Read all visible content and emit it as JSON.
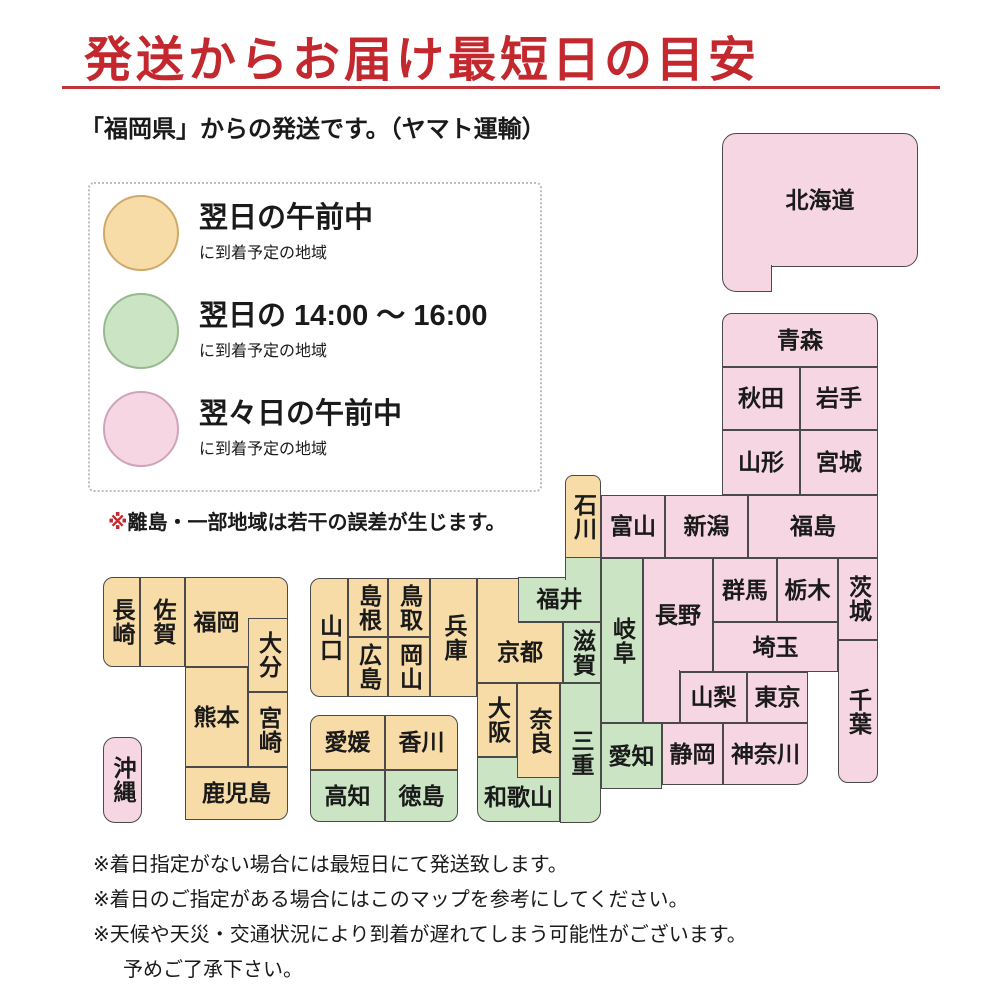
{
  "title": "発送からお届け最短日の目安",
  "subtitle": "「福岡県」からの発送です。（ヤマト運輸）",
  "colors": {
    "next_day_morning": "#f8dca8",
    "next_day_afternoon": "#cbe5c4",
    "two_days_later_morning": "#f5d6e2",
    "title_red": "#c3282e",
    "tile_border": "#4a4a4a"
  },
  "legend": {
    "items": [
      {
        "color": "orange",
        "label": "翌日の午前中",
        "sublabel": "に到着予定の地域"
      },
      {
        "color": "green",
        "label": "翌日の 14:00 ～ 16:00",
        "sublabel": "に到着予定の地域"
      },
      {
        "color": "pink",
        "label": "翌々日の午前中",
        "sublabel": "に到着予定の地域"
      }
    ],
    "note_mark": "※",
    "note": "離島・一部地域は若干の誤差が生じます。"
  },
  "map": {
    "prefectures": [
      {
        "key": "hokkaido",
        "name": "北海道",
        "color": "pink",
        "orient": "h",
        "parts": [
          {
            "x": 722,
            "y": 133,
            "w": 196,
            "h": 134,
            "r": "14px 14px 14px 0"
          },
          {
            "x": 722,
            "y": 265,
            "w": 50,
            "h": 27,
            "r": "0 0 0 14px",
            "b": "lrb"
          }
        ]
      },
      {
        "key": "aomori",
        "name": "青森",
        "color": "pink",
        "orient": "h",
        "parts": [
          {
            "x": 722,
            "y": 313,
            "w": 156,
            "h": 54,
            "r": "10px 10px 0 0"
          }
        ]
      },
      {
        "key": "akita",
        "name": "秋田",
        "color": "pink",
        "orient": "h",
        "parts": [
          {
            "x": 722,
            "y": 367,
            "w": 78,
            "h": 63
          }
        ]
      },
      {
        "key": "iwate",
        "name": "岩手",
        "color": "pink",
        "orient": "h",
        "parts": [
          {
            "x": 800,
            "y": 367,
            "w": 78,
            "h": 63
          }
        ]
      },
      {
        "key": "yamagata",
        "name": "山形",
        "color": "pink",
        "orient": "h",
        "parts": [
          {
            "x": 722,
            "y": 430,
            "w": 78,
            "h": 65
          }
        ]
      },
      {
        "key": "miyagi",
        "name": "宮城",
        "color": "pink",
        "orient": "h",
        "parts": [
          {
            "x": 800,
            "y": 430,
            "w": 78,
            "h": 65
          }
        ]
      },
      {
        "key": "niigata",
        "name": "新潟",
        "color": "pink",
        "orient": "h",
        "parts": [
          {
            "x": 665,
            "y": 495,
            "w": 83,
            "h": 63
          }
        ]
      },
      {
        "key": "fukushima",
        "name": "福島",
        "color": "pink",
        "orient": "h",
        "parts": [
          {
            "x": 748,
            "y": 495,
            "w": 130,
            "h": 63
          }
        ]
      },
      {
        "key": "toyama",
        "name": "富山",
        "color": "pink",
        "orient": "h",
        "parts": [
          {
            "x": 601,
            "y": 495,
            "w": 64,
            "h": 63
          }
        ]
      },
      {
        "key": "ishikawa",
        "name": "石川",
        "color": "orange",
        "orient": "v",
        "parts": [
          {
            "x": 565,
            "y": 475,
            "w": 36,
            "h": 83,
            "r": "8px 8px 0 0"
          }
        ]
      },
      {
        "key": "fukui",
        "name": "福井",
        "color": "green",
        "orient": "h",
        "parts": [
          {
            "x": 518,
            "y": 577,
            "w": 83,
            "h": 45
          },
          {
            "x": 565,
            "y": 558,
            "w": 36,
            "h": 22,
            "b": "lr"
          }
        ]
      },
      {
        "key": "gunma",
        "name": "群馬",
        "color": "pink",
        "orient": "h",
        "parts": [
          {
            "x": 713,
            "y": 558,
            "w": 64,
            "h": 64
          }
        ]
      },
      {
        "key": "tochigi",
        "name": "栃木",
        "color": "pink",
        "orient": "h",
        "parts": [
          {
            "x": 777,
            "y": 558,
            "w": 61,
            "h": 64
          }
        ]
      },
      {
        "key": "ibaraki",
        "name": "茨城",
        "color": "pink",
        "orient": "v",
        "parts": [
          {
            "x": 838,
            "y": 558,
            "w": 40,
            "h": 82
          }
        ]
      },
      {
        "key": "saitama",
        "name": "埼玉",
        "color": "pink",
        "orient": "h",
        "parts": [
          {
            "x": 713,
            "y": 622,
            "w": 125,
            "h": 50
          }
        ]
      },
      {
        "key": "chiba",
        "name": "千葉",
        "color": "pink",
        "orient": "v",
        "parts": [
          {
            "x": 838,
            "y": 640,
            "w": 40,
            "h": 143,
            "r": "0 0 10px 10px"
          }
        ]
      },
      {
        "key": "nagano",
        "name": "長野",
        "color": "pink",
        "orient": "h",
        "parts": [
          {
            "x": 643,
            "y": 558,
            "w": 70,
            "h": 114
          },
          {
            "x": 643,
            "y": 670,
            "w": 37,
            "h": 53,
            "b": "lrb"
          }
        ]
      },
      {
        "key": "gifu",
        "name": "岐阜",
        "color": "green",
        "orient": "v",
        "parts": [
          {
            "x": 601,
            "y": 558,
            "w": 42,
            "h": 165
          }
        ]
      },
      {
        "key": "yamanashi",
        "name": "山梨",
        "color": "pink",
        "orient": "h",
        "parts": [
          {
            "x": 680,
            "y": 672,
            "w": 67,
            "h": 51
          }
        ]
      },
      {
        "key": "tokyo",
        "name": "東京",
        "color": "pink",
        "orient": "h",
        "parts": [
          {
            "x": 747,
            "y": 672,
            "w": 61,
            "h": 51
          }
        ]
      },
      {
        "key": "kanagawa",
        "name": "神奈川",
        "color": "pink",
        "orient": "h",
        "parts": [
          {
            "x": 723,
            "y": 723,
            "w": 85,
            "h": 62,
            "r": "0 0 12px 0"
          }
        ]
      },
      {
        "key": "shizuoka",
        "name": "静岡",
        "color": "pink",
        "orient": "h",
        "parts": [
          {
            "x": 662,
            "y": 723,
            "w": 61,
            "h": 62
          }
        ]
      },
      {
        "key": "aichi",
        "name": "愛知",
        "color": "green",
        "orient": "h",
        "parts": [
          {
            "x": 601,
            "y": 723,
            "w": 61,
            "h": 66
          }
        ]
      },
      {
        "key": "shiga",
        "name": "滋賀",
        "color": "green",
        "orient": "v",
        "parts": [
          {
            "x": 563,
            "y": 622,
            "w": 38,
            "h": 61
          }
        ]
      },
      {
        "key": "kyoto",
        "name": "京都",
        "color": "orange",
        "orient": "h",
        "parts": [
          {
            "x": 477,
            "y": 622,
            "w": 86,
            "h": 61
          },
          {
            "x": 477,
            "y": 578,
            "w": 41,
            "h": 46,
            "b": "tl"
          }
        ]
      },
      {
        "key": "mie",
        "name": "三重",
        "color": "green",
        "orient": "v",
        "parts": [
          {
            "x": 560,
            "y": 683,
            "w": 41,
            "h": 140,
            "r": "0 0 12px 0"
          }
        ]
      },
      {
        "key": "osaka",
        "name": "大阪",
        "color": "orange",
        "orient": "v",
        "parts": [
          {
            "x": 477,
            "y": 683,
            "w": 40,
            "h": 74
          }
        ]
      },
      {
        "key": "wakayama",
        "name": "和歌山",
        "color": "green",
        "orient": "h",
        "parts": [
          {
            "x": 477,
            "y": 757,
            "w": 83,
            "h": 65,
            "r": "0 0 0 12px"
          }
        ],
        "label": {
          "x": 477,
          "y": 772,
          "w": 83,
          "h": 50
        }
      },
      {
        "key": "nara",
        "name": "奈良",
        "color": "orange",
        "orient": "v",
        "parts": [
          {
            "x": 517,
            "y": 683,
            "w": 43,
            "h": 95
          }
        ]
      },
      {
        "key": "hyogo",
        "name": "兵庫",
        "color": "orange",
        "orient": "v",
        "parts": [
          {
            "x": 430,
            "y": 578,
            "w": 47,
            "h": 119
          }
        ]
      },
      {
        "key": "tottori",
        "name": "鳥取",
        "color": "orange",
        "orient": "v",
        "parts": [
          {
            "x": 388,
            "y": 578,
            "w": 42,
            "h": 59
          }
        ]
      },
      {
        "key": "okayama",
        "name": "岡山",
        "color": "orange",
        "orient": "v",
        "parts": [
          {
            "x": 388,
            "y": 637,
            "w": 42,
            "h": 60
          }
        ]
      },
      {
        "key": "shimane",
        "name": "島根",
        "color": "orange",
        "orient": "v",
        "parts": [
          {
            "x": 348,
            "y": 578,
            "w": 40,
            "h": 59
          }
        ]
      },
      {
        "key": "hiroshima",
        "name": "広島",
        "color": "orange",
        "orient": "v",
        "parts": [
          {
            "x": 348,
            "y": 637,
            "w": 40,
            "h": 60
          }
        ]
      },
      {
        "key": "yamaguchi",
        "name": "山口",
        "color": "orange",
        "orient": "v",
        "parts": [
          {
            "x": 310,
            "y": 578,
            "w": 38,
            "h": 119,
            "r": "10px 0 0 10px"
          }
        ]
      },
      {
        "key": "ehime",
        "name": "愛媛",
        "color": "orange",
        "orient": "h",
        "parts": [
          {
            "x": 310,
            "y": 715,
            "w": 75,
            "h": 55,
            "r": "10px 0 0 0"
          }
        ]
      },
      {
        "key": "kagawa",
        "name": "香川",
        "color": "orange",
        "orient": "h",
        "parts": [
          {
            "x": 385,
            "y": 715,
            "w": 73,
            "h": 55,
            "r": "0 10px 0 0"
          }
        ]
      },
      {
        "key": "kochi",
        "name": "高知",
        "color": "green",
        "orient": "h",
        "parts": [
          {
            "x": 310,
            "y": 770,
            "w": 75,
            "h": 52,
            "r": "0 0 0 10px"
          }
        ]
      },
      {
        "key": "tokushima",
        "name": "徳島",
        "color": "green",
        "orient": "h",
        "parts": [
          {
            "x": 385,
            "y": 770,
            "w": 73,
            "h": 52,
            "r": "0 0 10px 0"
          }
        ]
      },
      {
        "key": "fukuoka",
        "name": "福岡",
        "color": "orange",
        "orient": "h",
        "parts": [
          {
            "x": 185,
            "y": 577,
            "w": 103,
            "h": 90,
            "r": "0 10px 0 0"
          }
        ],
        "label": {
          "x": 185,
          "y": 577,
          "w": 63,
          "h": 90
        }
      },
      {
        "key": "saga",
        "name": "佐賀",
        "color": "orange",
        "orient": "v",
        "parts": [
          {
            "x": 140,
            "y": 577,
            "w": 45,
            "h": 90
          }
        ]
      },
      {
        "key": "nagasaki",
        "name": "長崎",
        "color": "orange",
        "orient": "v",
        "parts": [
          {
            "x": 103,
            "y": 577,
            "w": 37,
            "h": 90,
            "r": "10px 0 0 10px"
          }
        ]
      },
      {
        "key": "oita",
        "name": "大分",
        "color": "orange",
        "orient": "v",
        "parts": [
          {
            "x": 248,
            "y": 618,
            "w": 40,
            "h": 74
          }
        ]
      },
      {
        "key": "kumamoto",
        "name": "熊本",
        "color": "orange",
        "orient": "h",
        "parts": [
          {
            "x": 185,
            "y": 667,
            "w": 63,
            "h": 100
          }
        ]
      },
      {
        "key": "miyazaki",
        "name": "宮崎",
        "color": "orange",
        "orient": "v",
        "parts": [
          {
            "x": 248,
            "y": 692,
            "w": 40,
            "h": 75
          }
        ]
      },
      {
        "key": "kagoshima",
        "name": "鹿児島",
        "color": "orange",
        "orient": "h",
        "parts": [
          {
            "x": 185,
            "y": 767,
            "w": 103,
            "h": 53,
            "r": "0 0 10px 0"
          }
        ]
      },
      {
        "key": "okinawa",
        "name": "沖縄",
        "color": "pink",
        "orient": "v",
        "parts": [
          {
            "x": 103,
            "y": 737,
            "w": 39,
            "h": 86,
            "r": "12px"
          }
        ]
      }
    ]
  },
  "footnotes": [
    "※着日指定がない場合には最短日にて発送致します。",
    "※着日のご指定がある場合にはこのマップを参考にしてください。",
    "※天候や天災・交通状況により到着が遅れてしまう可能性がございます。",
    "予めご了承下さい。"
  ]
}
